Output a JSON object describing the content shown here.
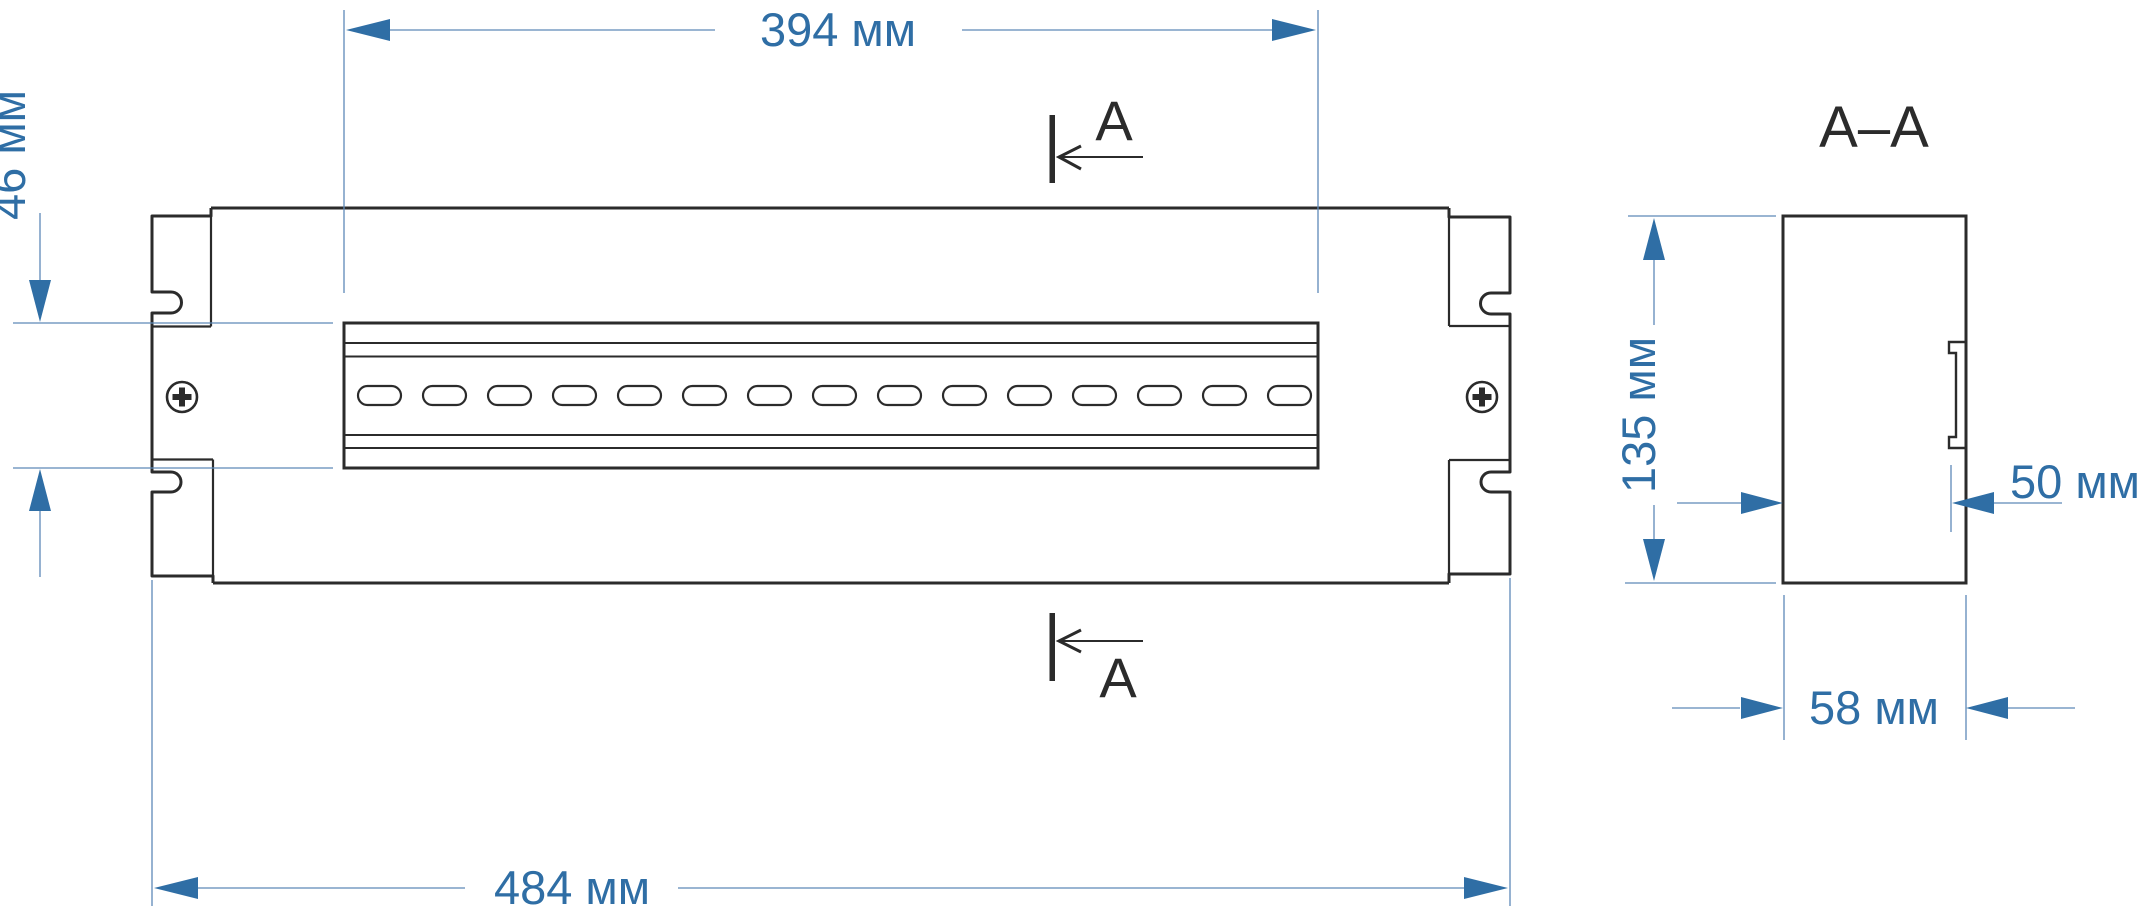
{
  "front": {
    "dim_top": "394 мм",
    "dim_left": "46 мм",
    "dim_bottom": "484 мм",
    "section_top": "A",
    "section_bottom": "A"
  },
  "section": {
    "title": "A–A",
    "dim_height": "135 мм",
    "dim_depth": "50 мм",
    "dim_width": "58 мм"
  },
  "colors": {
    "dimension_blue": "#2f6ea5",
    "thin_blue": "#5d89b8",
    "outline_black": "#2b2b2b"
  }
}
